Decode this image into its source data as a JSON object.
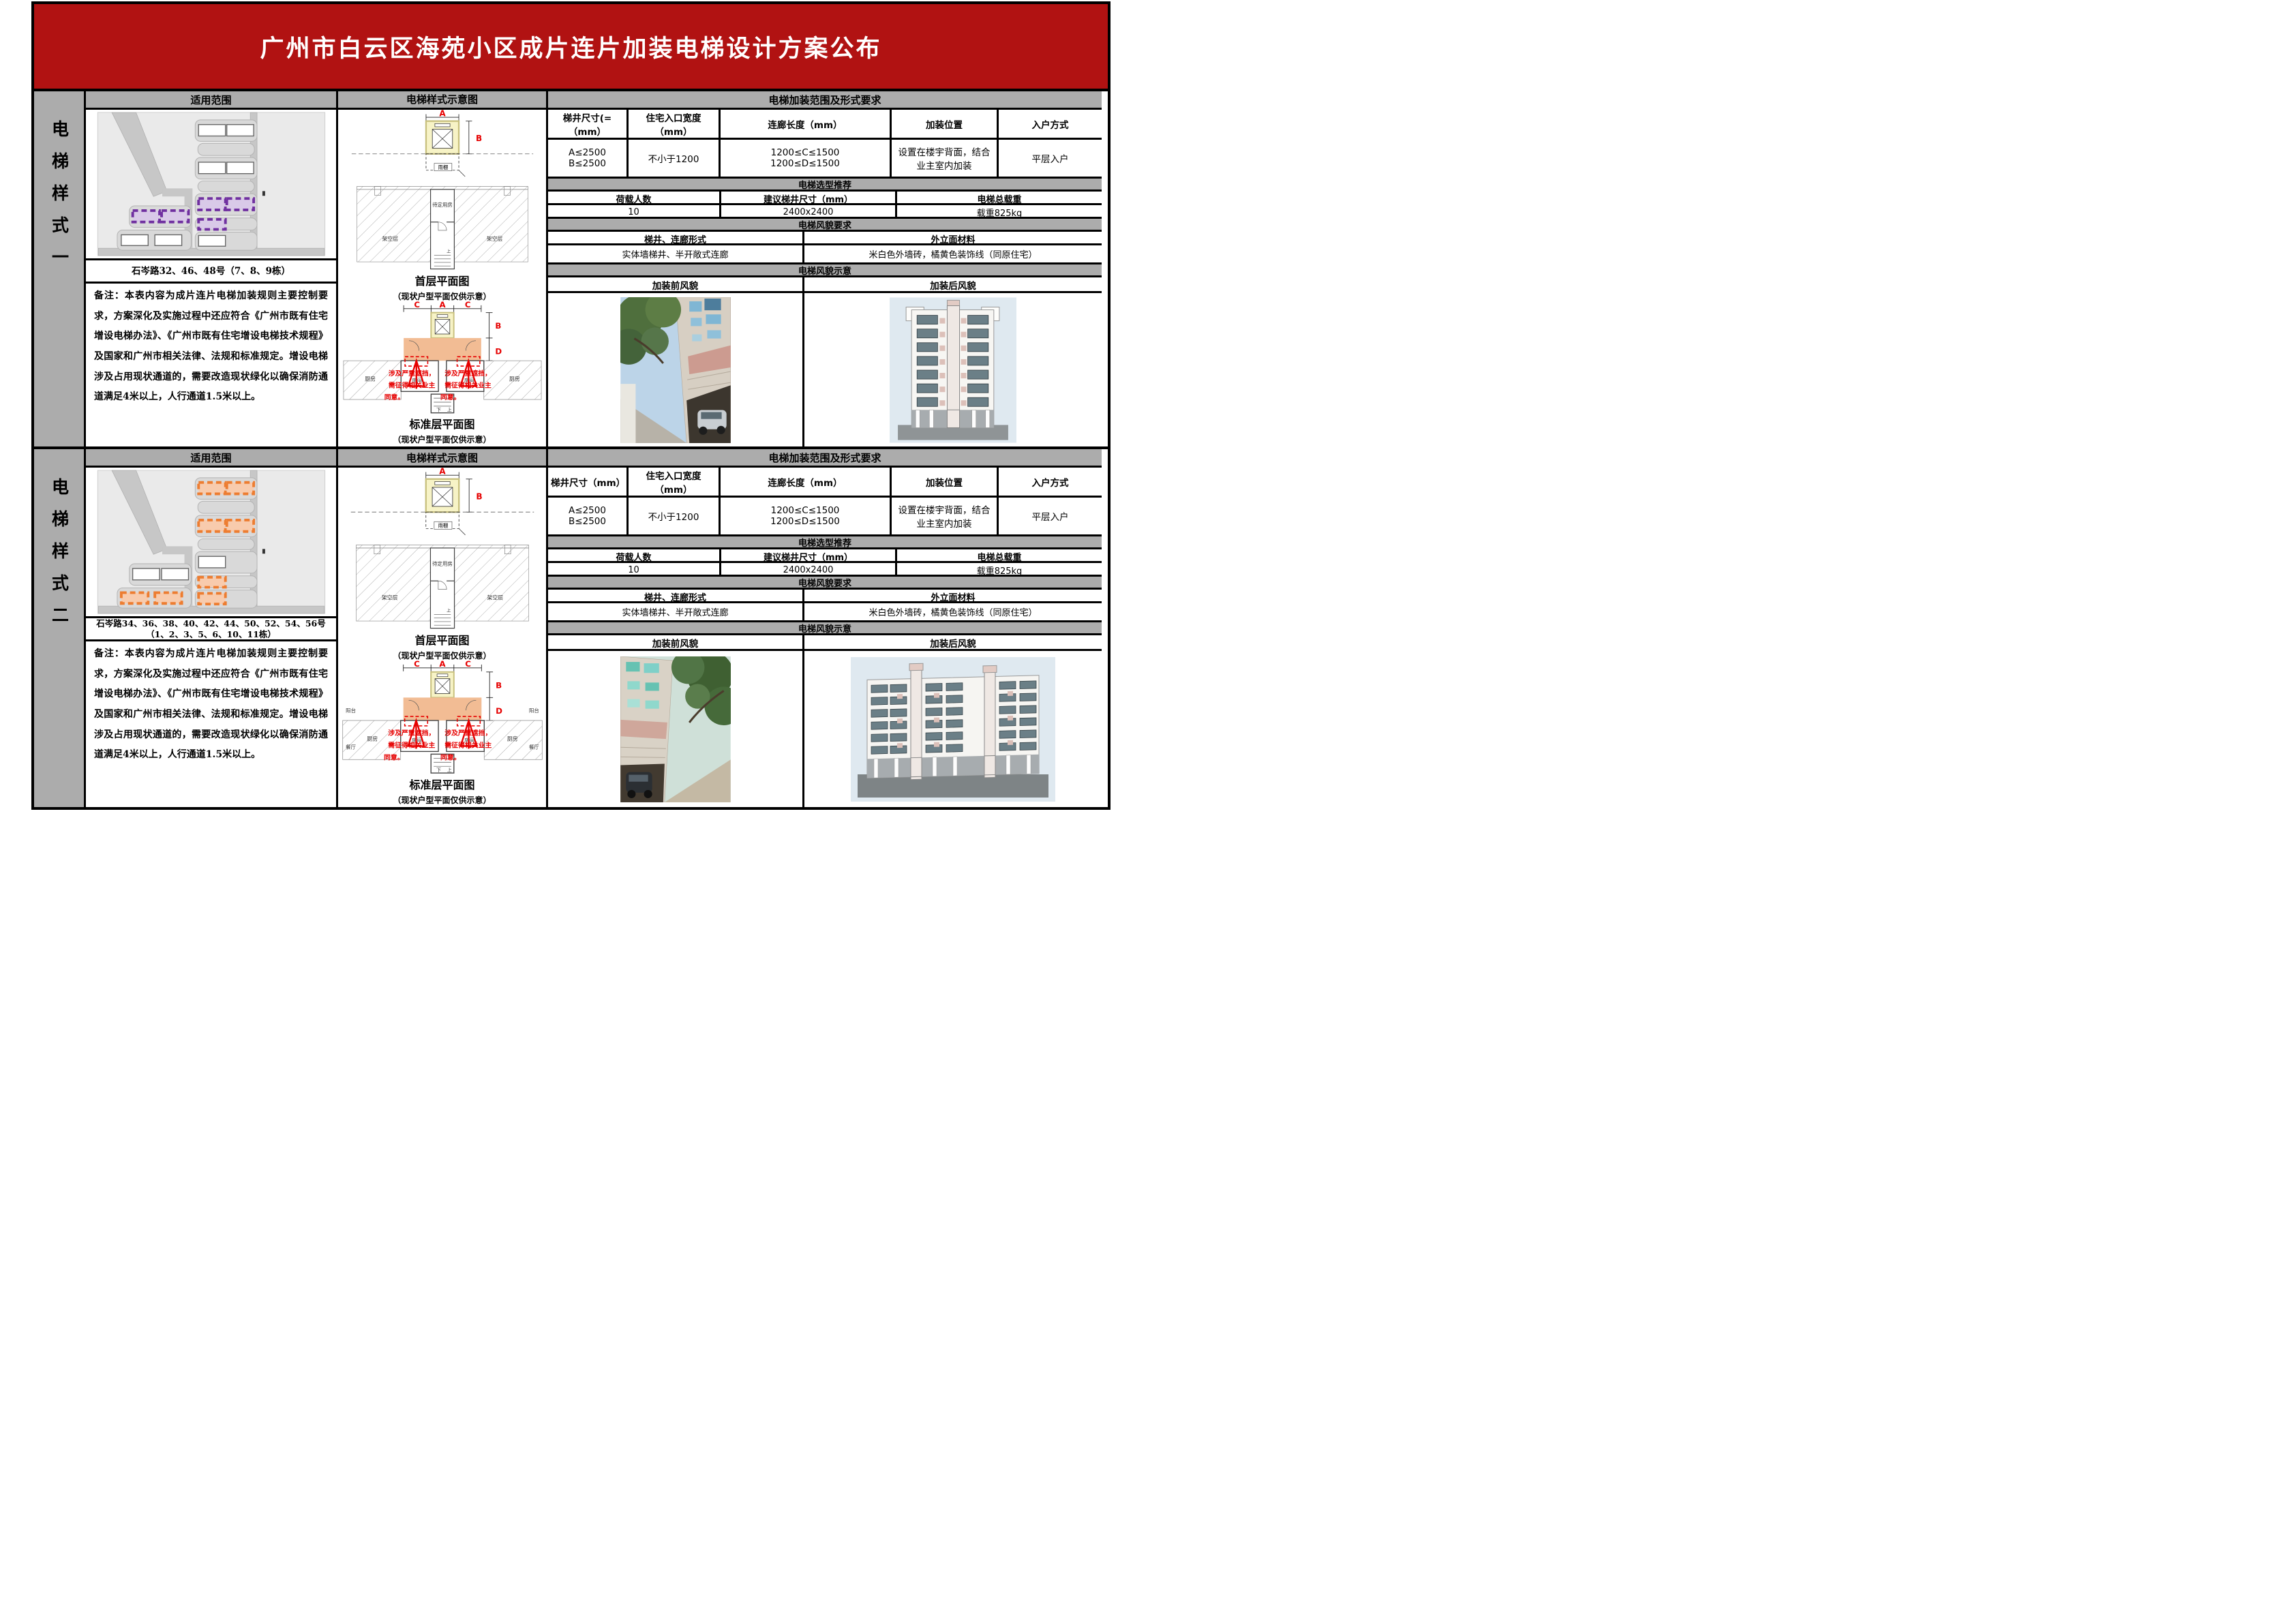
{
  "title": "广州市白云区海苑小区成片连片加装电梯设计方案公布",
  "colors": {
    "banner": "#b11212",
    "band": "#acacac",
    "highlight_style1": "#7030a0",
    "highlight_style1_light": "#d9c9e8",
    "highlight_style2": "#ed7d31",
    "highlight_style2_light": "#f8cbad",
    "shaft_fill": "#f7f3c6",
    "shaft_border": "#c8c07e",
    "corridor_fill": "#f2bc94",
    "annotation": "#e60000"
  },
  "sections": [
    {
      "side_label": "电梯样式一",
      "scope": {
        "header": "适用范围",
        "address": "石岑路32、46、48号（7、8、9栋）",
        "note": "备注：本表内容为成片连片电梯加装规则主要控制要求，方案深化及实施过程中还应符合《广州市既有住宅增设电梯办法》、《广州市既有住宅增设电梯技术规程》及国家和广州市相关法律、法规和标准规定。增设电梯涉及占用现状通道的，需要改造现状绿化以确保消防通道满足4米以上，人行通道1.5米以上。"
      },
      "diagram": {
        "header": "电梯样式示意图",
        "dims": {
          "a": "A",
          "b": "B",
          "c": "C",
          "d": "D"
        },
        "labels": {
          "canopy": "雨棚",
          "pending_room": "待定用房",
          "stilt": "架空层",
          "kitchen": "厨房",
          "room": "房间",
          "up": "上",
          "down": "下"
        },
        "warning_lines": [
          "涉及严重遮挡，",
          "需征得相关业主",
          "同意。"
        ],
        "first_floor_caption": "首层平面图",
        "first_floor_note": "（现状户型平面仅供示意）",
        "standard_caption": "标准层平面图",
        "standard_note": "（现状户型平面仅供示意）"
      },
      "requirements": {
        "header": "电梯加装范围及形式要求",
        "col_headers": [
          "梯井尺寸(=（mm）",
          "住宅入口宽度（mm）",
          "连廊长度（mm）",
          "加装位置",
          "入户方式"
        ],
        "col_values": [
          "A≤2500\nB≤2500",
          "不小于1200",
          "1200≤C≤1500\n1200≤D≤1500",
          "设置在楼宇背面，结合业主室内加装",
          "平层入户"
        ]
      },
      "selection": {
        "header": "电梯选型推荐",
        "col_headers": [
          "荷载人数",
          "建议梯井尺寸（mm）",
          "电梯总载重"
        ],
        "col_values": [
          "10",
          "2400x2400",
          "载重825kg"
        ]
      },
      "appearance": {
        "header": "电梯风貌要求",
        "col_headers": [
          "梯井、连廊形式",
          "外立面材料"
        ],
        "col_values": [
          "实体墙梯井、半开敞式连廊",
          "米白色外墙砖，橘黄色装饰线（同原住宅）"
        ]
      },
      "demo": {
        "header": "电梯风貌示意",
        "col_headers": [
          "加装前风貌",
          "加装后风貌"
        ]
      }
    },
    {
      "side_label": "电梯样式二",
      "scope": {
        "header": "适用范围",
        "address": "石岑路34、36、38、40、42、44、50、52、54、56号（1、2、3、5、6、10、11栋）",
        "note": "备注：本表内容为成片连片电梯加装规则主要控制要求，方案深化及实施过程中还应符合《广州市既有住宅增设电梯办法》、《广州市既有住宅增设电梯技术规程》及国家和广州市相关法律、法规和标准规定。增设电梯涉及占用现状通道的，需要改造现状绿化以确保消防通道满足4米以上，人行通道1.5米以上。"
      },
      "diagram": {
        "header": "电梯样式示意图",
        "dims": {
          "a": "A",
          "b": "B",
          "c": "C",
          "d": "D"
        },
        "labels": {
          "canopy": "雨棚",
          "pending_room": "待定用房",
          "stilt": "架空层",
          "kitchen": "厨房",
          "room": "房间",
          "balcony": "阳台",
          "dining": "餐厅",
          "up": "上",
          "down": "下"
        },
        "warning_lines": [
          "涉及严重遮挡，",
          "需征得相关业主",
          "同意。"
        ],
        "first_floor_caption": "首层平面图",
        "first_floor_note": "（现状户型平面仅供示意）",
        "standard_caption": "标准层平面图",
        "standard_note": "（现状户型平面仅供示意）"
      },
      "requirements": {
        "header": "电梯加装范围及形式要求",
        "col_headers": [
          "梯井尺寸（mm）",
          "住宅入口宽度（mm）",
          "连廊长度（mm）",
          "加装位置",
          "入户方式"
        ],
        "col_values": [
          "A≤2500\nB≤2500",
          "不小于1200",
          "1200≤C≤1500\n1200≤D≤1500",
          "设置在楼宇背面，结合业主室内加装",
          "平层入户"
        ]
      },
      "selection": {
        "header": "电梯选型推荐",
        "col_headers": [
          "荷载人数",
          "建议梯井尺寸（mm）",
          "电梯总载重"
        ],
        "col_values": [
          "10",
          "2400x2400",
          "载重825kg"
        ]
      },
      "appearance": {
        "header": "电梯风貌要求",
        "col_headers": [
          "梯井、连廊形式",
          "外立面材料"
        ],
        "col_values": [
          "实体墙梯井、半开敞式连廊",
          "米白色外墙砖，橘黄色装饰线（同原住宅）"
        ]
      },
      "demo": {
        "header": "电梯风貌示意",
        "col_headers": [
          "加装前风貌",
          "加装后风貌"
        ]
      }
    }
  ]
}
